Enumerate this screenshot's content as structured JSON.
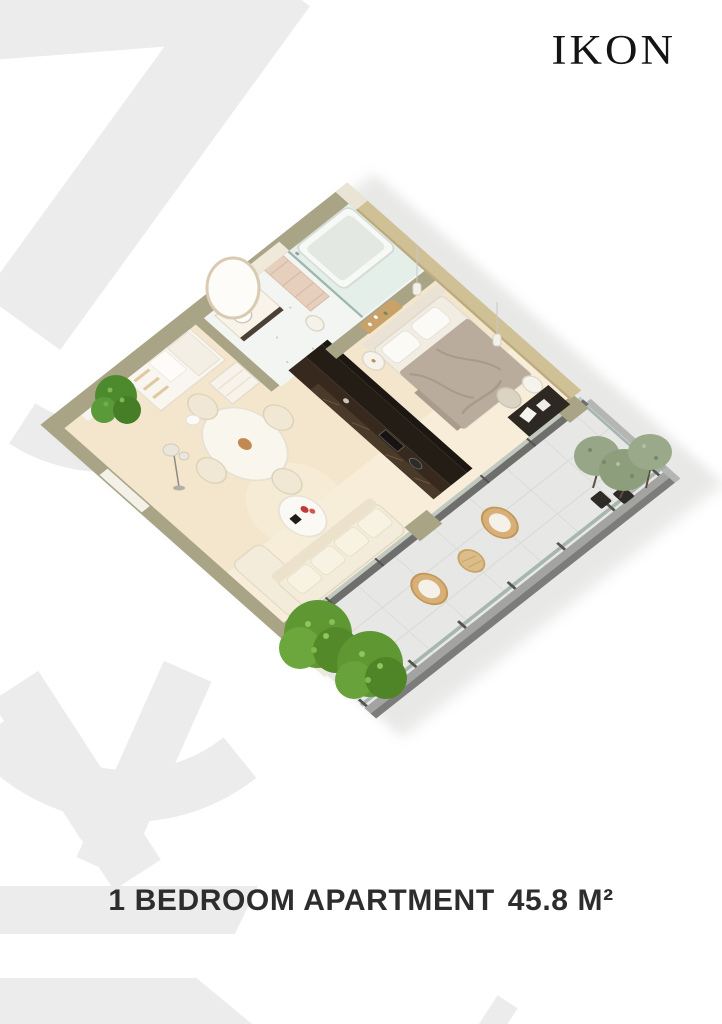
{
  "brand": {
    "name": "IKON"
  },
  "caption": {
    "label": "1 BEDROOM APARTMENT",
    "area": "45.8 M²"
  },
  "floorplan": {
    "view": "isometric 3D apartment render",
    "rooms": [
      "entry hall",
      "bathroom",
      "kitchen",
      "living-dining room",
      "bedroom",
      "balcony"
    ],
    "colors": {
      "wall": "#a9a486",
      "wall_inner_tan": "#cfc096",
      "floor": "#f3e6cc",
      "floor_light": "#f8efdc",
      "bathroom_floor": "#f3f5f2",
      "shower_glass": "#e2eee8",
      "kitchen_dark": "#37291d",
      "kitchen_tall": "#241d16",
      "balcony_floor": "#e7e7e5",
      "bedding": "#b9ac9d",
      "sofa": "#f3ecda",
      "rattan": "#d8af76",
      "bush_green": "#5f9832",
      "olive_tree": "#96a687",
      "pot": "#2e2b27"
    }
  },
  "watermark": {
    "color": "#ececec"
  }
}
